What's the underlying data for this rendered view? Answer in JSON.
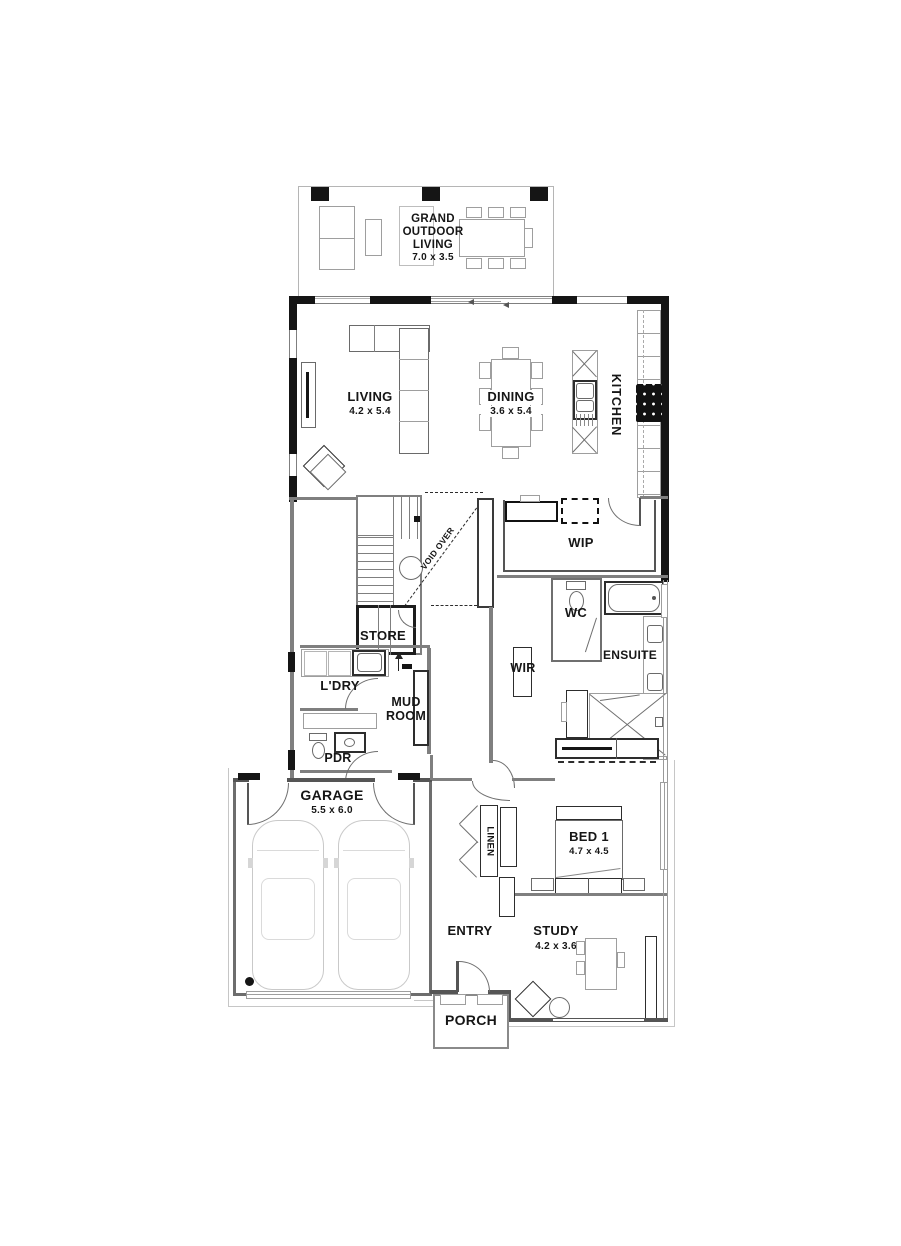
{
  "colors": {
    "wall_black": "#151515",
    "interior_wall_grey": "#7f7f7f",
    "furniture_grey": "#9e9e9e",
    "slab_line_grey": "#c6c6c6",
    "background": "#ffffff",
    "text": "#161616"
  },
  "rooms": {
    "grand_outdoor_living": {
      "name": "GRAND OUTDOOR LIVING",
      "dims": "7.0 x 3.5"
    },
    "living": {
      "name": "LIVING",
      "dims": "4.2 x 5.4"
    },
    "dining": {
      "name": "DINING",
      "dims": "3.6 x 5.4"
    },
    "kitchen": {
      "name": "KITCHEN"
    },
    "wip": {
      "name": "WIP"
    },
    "void": {
      "name": "VOID OVER"
    },
    "store": {
      "name": "STORE"
    },
    "wc": {
      "name": "WC"
    },
    "ensuite": {
      "name": "ENSUITE"
    },
    "wir": {
      "name": "WIR"
    },
    "laundry": {
      "name": "L'DRY"
    },
    "mud_room": {
      "name": "MUD ROOM"
    },
    "pdr": {
      "name": "PDR"
    },
    "garage": {
      "name": "GARAGE",
      "dims": "5.5 x 6.0"
    },
    "linen": {
      "name": "LINEN"
    },
    "bed1": {
      "name": "BED 1",
      "dims": "4.7 x 4.5"
    },
    "entry": {
      "name": "ENTRY"
    },
    "study": {
      "name": "STUDY",
      "dims": "4.2 x 3.6"
    },
    "porch": {
      "name": "PORCH"
    }
  }
}
